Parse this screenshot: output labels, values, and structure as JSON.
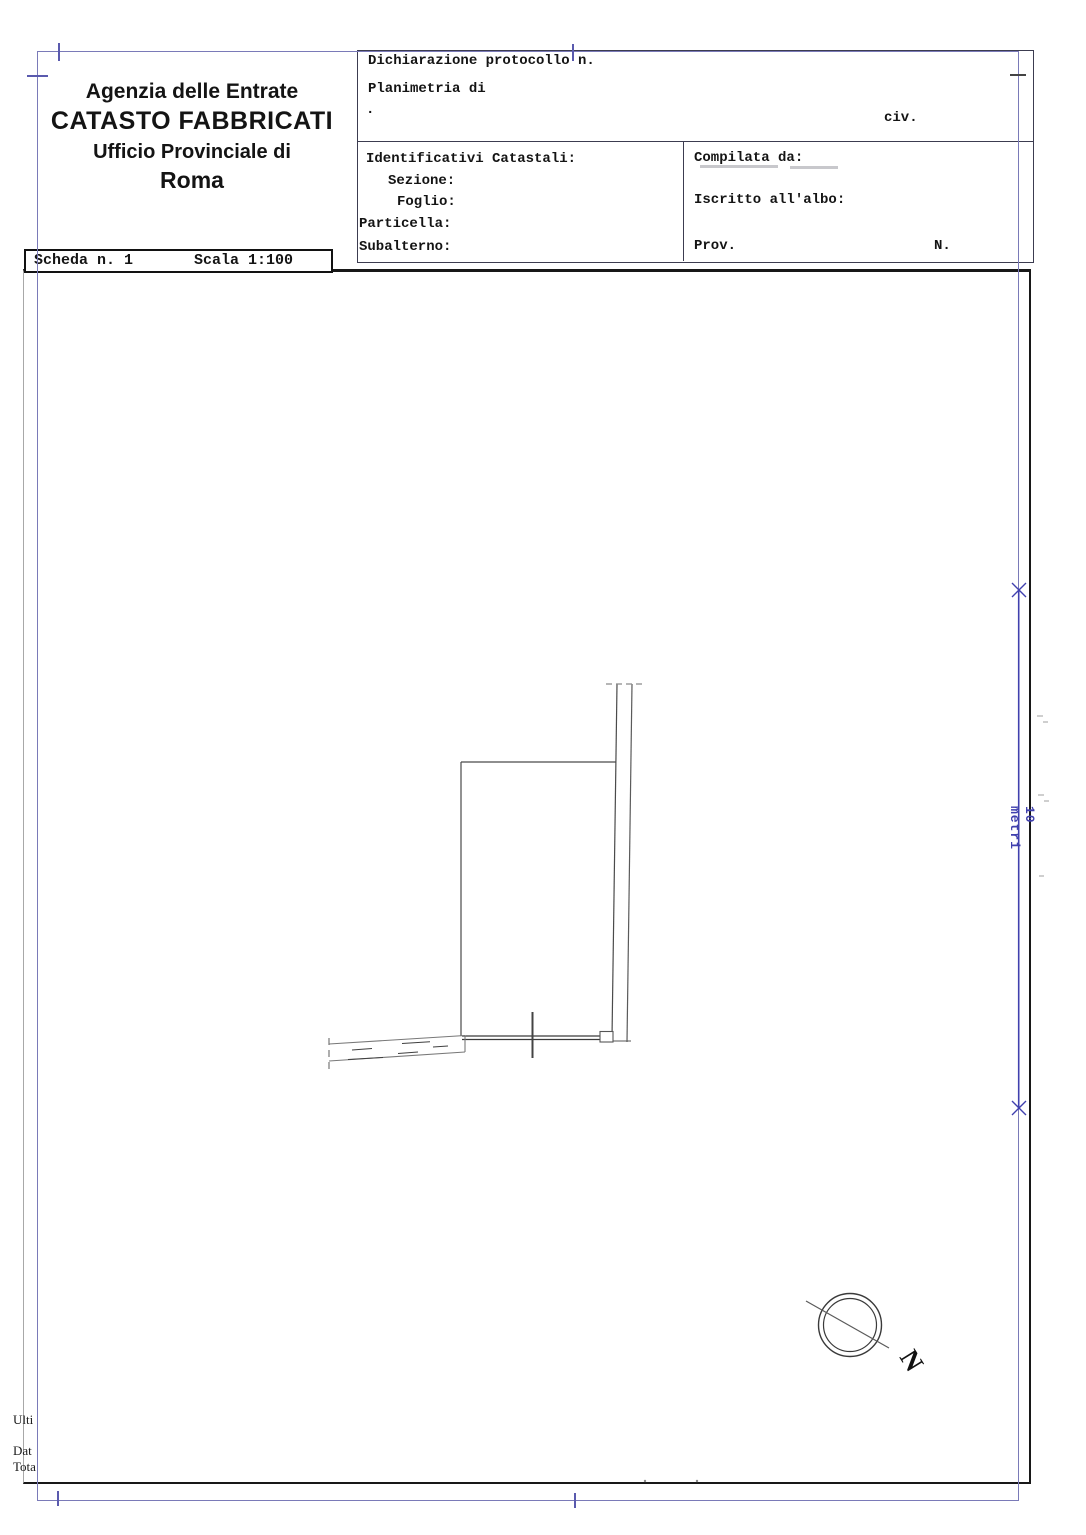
{
  "header": {
    "agency": "Agenzia delle Entrate",
    "office": "CATASTO FABBRICATI",
    "provincial_label": "Ufficio Provinciale di",
    "city": "Roma"
  },
  "scheda": {
    "number_label": "Scheda n. 1",
    "scale_label": "Scala 1:100"
  },
  "declaration": {
    "protocol_label": "Dichiarazione protocollo n.",
    "protocol_clipped": "RM0147662",
    "date_clipped": "26/06/2015",
    "planimetria_label": "Planimetria di",
    "address_remnant": ".",
    "civ_label": "civ."
  },
  "identifiers": {
    "title": "Identificativi Catastali:",
    "sezione": "Sezione:",
    "foglio": "Foglio:",
    "particella": "Particella:",
    "subalterno": "Subalterno:"
  },
  "compiler": {
    "compilata": "Compilata da:",
    "iscritto": "Iscritto all'albo:",
    "prov": "Prov.",
    "n": "N."
  },
  "scale_bar": {
    "label": "10 metri"
  },
  "compass": {
    "north": "N"
  },
  "footer": {
    "line1": "Ulti",
    "line2": "Dat",
    "line3": "Tota"
  },
  "colors": {
    "border_blue": "#7a7ab8",
    "dimension_blue": "#4040ae",
    "plan_line": "#555555",
    "ink": "#141414"
  }
}
